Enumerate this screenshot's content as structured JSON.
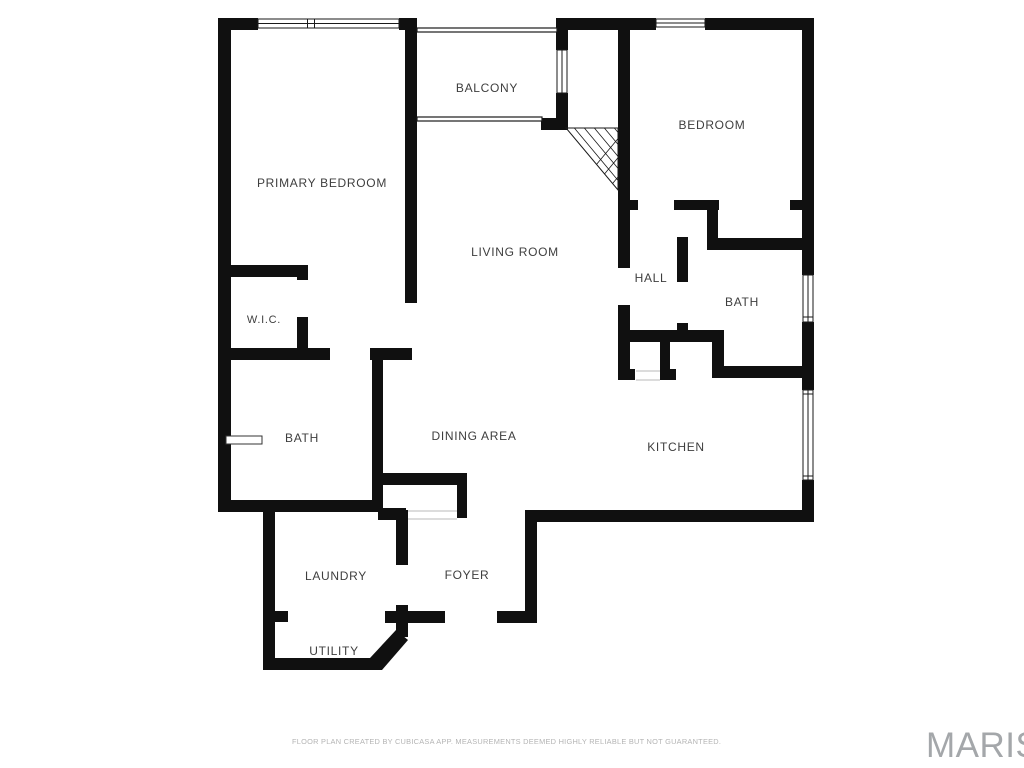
{
  "footer": {
    "disclaimer": "FLOOR PLAN CREATED BY CUBICASA APP. MEASUREMENTS DEEMED HIGHLY RELIABLE BUT NOT GUARANTEED.",
    "brand": "MARIS"
  },
  "plan": {
    "wall_color": "#101010",
    "thin_line_color": "#1a1a1a",
    "threshold_line_color": "#b9b9b9",
    "label_color": "#3e3e3e",
    "rooms": [
      {
        "id": "balcony",
        "label": "BALCONY",
        "x": 487,
        "y": 88,
        "size": 12
      },
      {
        "id": "primary-bedroom",
        "label": "PRIMARY BEDROOM",
        "x": 322,
        "y": 183,
        "size": 12
      },
      {
        "id": "bedroom",
        "label": "BEDROOM",
        "x": 712,
        "y": 125,
        "size": 12
      },
      {
        "id": "living-room",
        "label": "LIVING ROOM",
        "x": 515,
        "y": 252,
        "size": 12
      },
      {
        "id": "hall",
        "label": "HALL",
        "x": 651,
        "y": 278,
        "size": 12
      },
      {
        "id": "bath-hall",
        "label": "BATH",
        "x": 742,
        "y": 302,
        "size": 12
      },
      {
        "id": "wic",
        "label": "W.I.C.",
        "x": 264,
        "y": 320,
        "size": 11
      },
      {
        "id": "bath-primary",
        "label": "BATH",
        "x": 302,
        "y": 438,
        "size": 12
      },
      {
        "id": "dining-area",
        "label": "DINING AREA",
        "x": 474,
        "y": 436,
        "size": 12
      },
      {
        "id": "kitchen",
        "label": "KITCHEN",
        "x": 676,
        "y": 447,
        "size": 12
      },
      {
        "id": "laundry",
        "label": "LAUNDRY",
        "x": 336,
        "y": 576,
        "size": 12
      },
      {
        "id": "foyer",
        "label": "FOYER",
        "x": 467,
        "y": 575,
        "size": 12
      },
      {
        "id": "utility",
        "label": "UTILITY",
        "x": 334,
        "y": 651,
        "size": 12
      }
    ],
    "walls": [
      [
        218,
        18,
        40,
        12
      ],
      [
        399,
        18,
        18,
        12
      ],
      [
        556,
        18,
        100,
        12
      ],
      [
        705,
        18,
        109,
        12
      ],
      [
        218,
        18,
        13,
        494
      ],
      [
        802,
        18,
        12,
        257
      ],
      [
        802,
        322,
        12,
        68
      ],
      [
        802,
        480,
        12,
        42
      ],
      [
        525,
        510,
        289,
        12
      ],
      [
        525,
        510,
        12,
        113
      ],
      [
        497,
        611,
        40,
        12
      ],
      [
        385,
        611,
        60,
        12
      ],
      [
        396,
        510,
        12,
        55
      ],
      [
        396,
        605,
        12,
        32
      ],
      [
        263,
        658,
        114,
        12
      ],
      [
        263,
        512,
        12,
        158
      ],
      [
        218,
        500,
        165,
        12
      ],
      [
        372,
        352,
        11,
        160
      ],
      [
        378,
        473,
        89,
        12
      ],
      [
        457,
        473,
        10,
        45
      ],
      [
        378,
        508,
        28,
        12
      ],
      [
        263,
        611,
        25,
        11
      ],
      [
        218,
        265,
        90,
        12
      ],
      [
        297,
        265,
        11,
        15
      ],
      [
        297,
        317,
        11,
        43
      ],
      [
        218,
        348,
        112,
        12
      ],
      [
        370,
        348,
        42,
        12
      ],
      [
        405,
        18,
        12,
        285
      ],
      [
        556,
        18,
        12,
        32
      ],
      [
        556,
        93,
        12,
        37
      ],
      [
        541,
        118,
        27,
        12
      ],
      [
        618,
        18,
        12,
        250
      ],
      [
        618,
        305,
        12,
        75
      ],
      [
        618,
        369,
        17,
        11
      ],
      [
        618,
        200,
        20,
        10
      ],
      [
        674,
        200,
        45,
        10
      ],
      [
        790,
        200,
        24,
        10
      ],
      [
        707,
        200,
        11,
        42
      ],
      [
        707,
        238,
        107,
        12
      ],
      [
        677,
        237,
        11,
        45
      ],
      [
        677,
        323,
        11,
        19
      ],
      [
        618,
        330,
        105,
        12
      ],
      [
        712,
        330,
        12,
        48
      ],
      [
        712,
        366,
        102,
        12
      ],
      [
        660,
        330,
        10,
        50
      ],
      [
        660,
        369,
        16,
        11
      ]
    ],
    "polygons": [
      {
        "name": "diagonal-wall",
        "points": "370,658 396,630 408,640 382,670 370,670"
      }
    ],
    "windows": [
      {
        "name": "window-primary-top",
        "x": 258,
        "y": 19,
        "w": 141,
        "h": 9,
        "dividers": [
          307.5,
          314.5
        ]
      },
      {
        "name": "window-bedroom-top",
        "x": 656,
        "y": 19,
        "w": 49,
        "h": 8,
        "dividers": []
      },
      {
        "name": "window-bath-right",
        "x": 803,
        "y": 275,
        "w": 10,
        "h": 47,
        "dividers": [
          317
        ]
      },
      {
        "name": "window-kitchen-right",
        "x": 803,
        "y": 390,
        "w": 10,
        "h": 90,
        "dividers": [
          394,
          476
        ]
      },
      {
        "name": "window-balcony-side",
        "x": 557,
        "y": 50,
        "w": 10,
        "h": 43,
        "dividers": []
      }
    ],
    "railings": [
      {
        "name": "balcony-railing-top",
        "x": 417,
        "y": 28,
        "w": 140,
        "h": 4
      },
      {
        "name": "balcony-railing-bottom",
        "x": 417,
        "y": 117,
        "w": 125,
        "h": 4
      }
    ],
    "thresholds": [
      {
        "name": "foyer-closet-threshold",
        "x": 408,
        "y": 511,
        "w": 49,
        "h": 8
      },
      {
        "name": "hall-closet-threshold",
        "x": 636,
        "y": 371,
        "w": 24,
        "h": 9
      }
    ],
    "fixtures": [
      {
        "name": "bath-fixture-bar",
        "x": 226,
        "y": 436,
        "w": 36,
        "h": 8
      }
    ],
    "stairs": {
      "triangle": "566,128 618,128 618,190",
      "x": 556,
      "y": 118,
      "w": 75,
      "h": 85
    }
  }
}
